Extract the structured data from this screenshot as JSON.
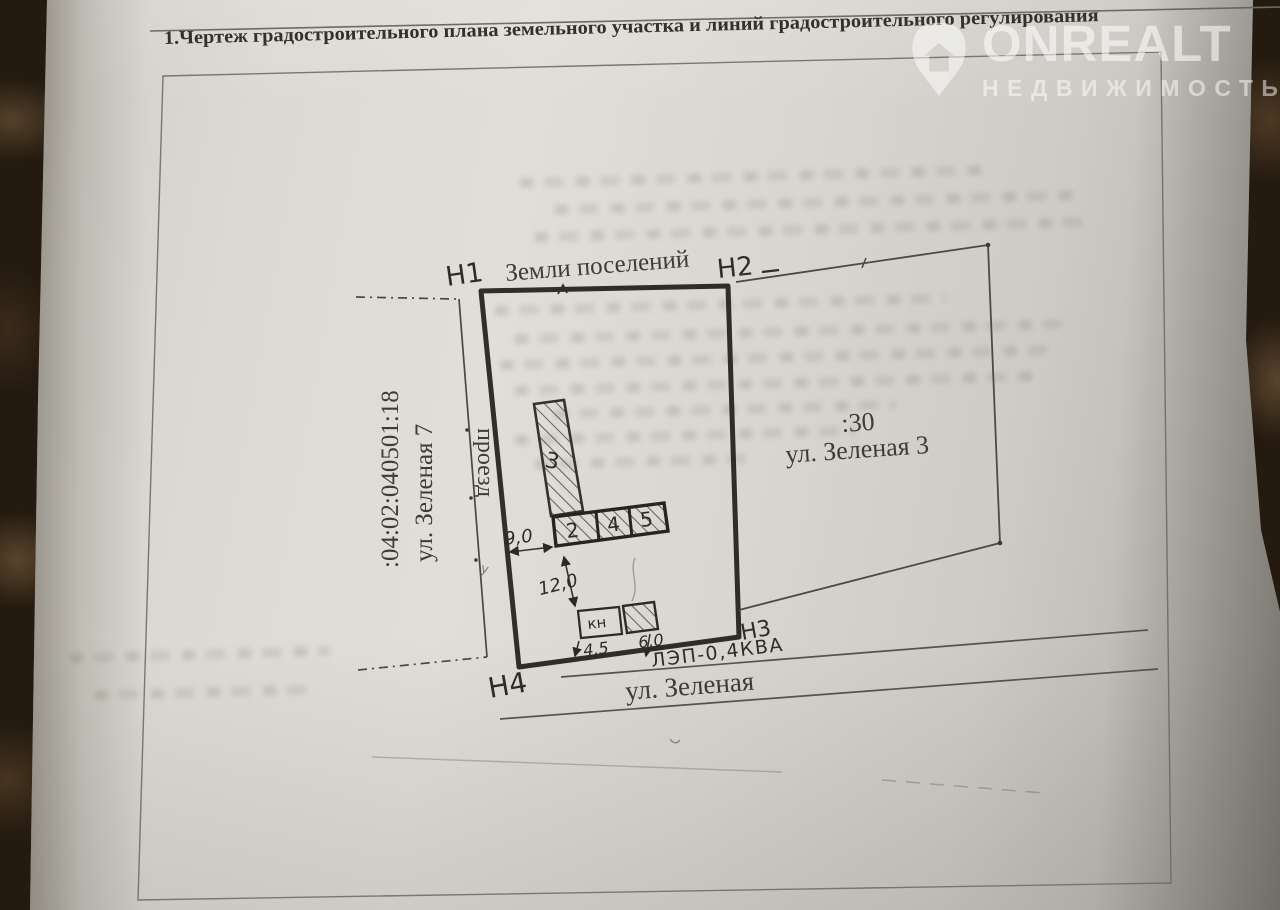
{
  "document": {
    "title": "1.Чертеж градостроительного плана земельного участка и линий градостроительного регулирования"
  },
  "watermark": {
    "brand": "ONREALT",
    "tagline": "НЕДВИЖИМОСТЬ"
  },
  "plan": {
    "land_category": "Земли поселений",
    "boundary_points": {
      "n1": "Н1",
      "n2": "Н2",
      "n3": "Н3",
      "n4": "Н4"
    },
    "adjacent_parcel_left": {
      "cadastral_number": ":04:02:040501:18",
      "address": "ул. Зеленая 7"
    },
    "adjacent_parcel_right": {
      "number": ":30",
      "address": "ул. Зеленая 3"
    },
    "passage_label": "проезд",
    "street_label": "ул. Зеленая",
    "power_line_label": "ЛЭП-0,4КВА",
    "buildings": {
      "main": "3",
      "cells": [
        "2",
        "4",
        "5"
      ],
      "shed": "кн"
    },
    "dimensions": {
      "dim1": "9,0",
      "dim2": "12,0",
      "dim3": "4,5",
      "dim4": "6,0"
    },
    "pencil_mark": "у"
  }
}
